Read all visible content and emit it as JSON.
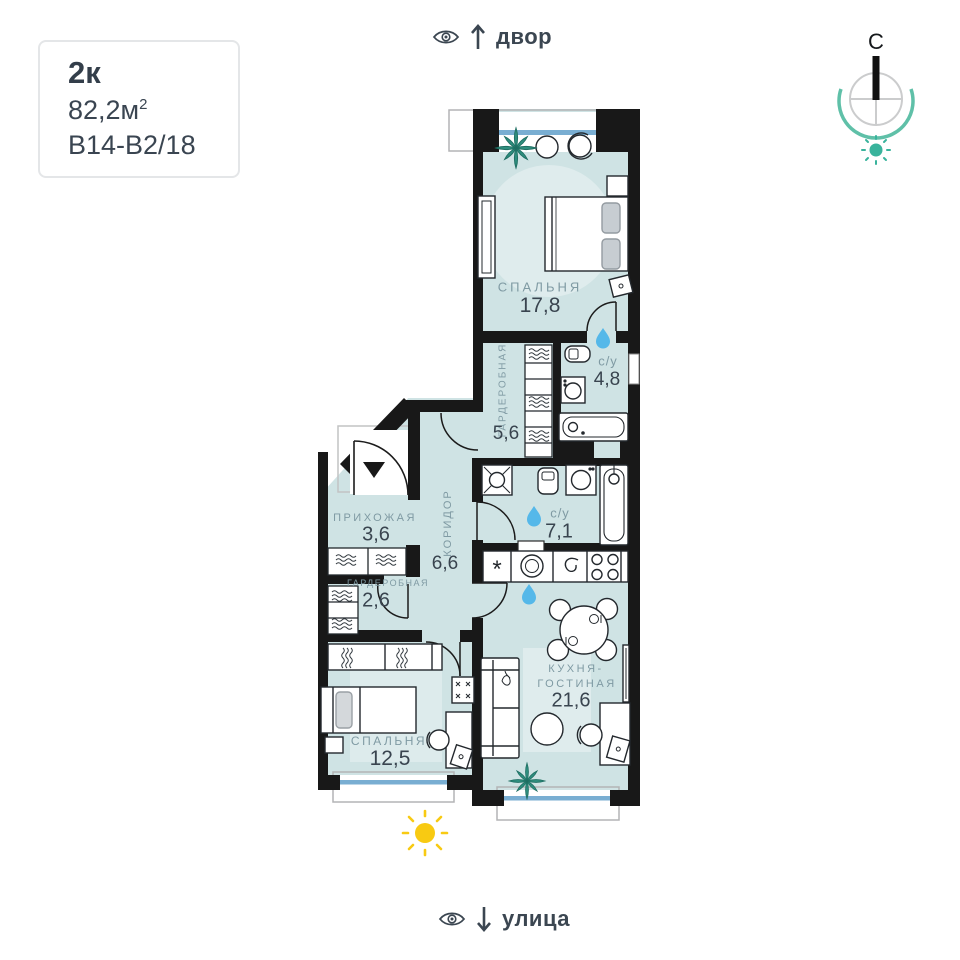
{
  "card": {
    "type_label": "2к",
    "area_value": "82,2м",
    "area_sup": "2",
    "plan_code": "В14-В2/18"
  },
  "orientation": {
    "top_view_label": "двор",
    "bottom_view_label": "улица",
    "compass_north": "С"
  },
  "rooms": {
    "bedroom_main": {
      "name": "СПАЛЬНЯ",
      "area": "17,8"
    },
    "wardrobe_main": {
      "name": "ГАРДЕРОБНАЯ",
      "area": "5,6"
    },
    "bathroom_main": {
      "name": "с/у",
      "area": "4,8"
    },
    "hallway": {
      "name": "ПРИХОЖАЯ",
      "area": "3,6"
    },
    "bathroom_guest": {
      "name": "с/у",
      "area": "7,1"
    },
    "wardrobe_hall": {
      "name": "ГАРДЕРОБНАЯ",
      "area": "2,6"
    },
    "corridor": {
      "name": "КОРИДОР",
      "area": "6,6"
    },
    "kitchen_living": {
      "name_line1": "КУХНЯ-",
      "name_line2": "ГОСТИНАЯ",
      "area": "21,6"
    },
    "bedroom_second": {
      "name": "СПАЛЬНЯ",
      "area": "12,5"
    }
  },
  "symbols": {
    "fridge_symbol": "*"
  },
  "colors": {
    "room_fill": "#cfe3e4",
    "wall": "#181818",
    "window_glass_blue": "#79aed2",
    "water_drop_blue": "#55b8e9",
    "plant_teal": "#2f8f7f",
    "compass_teal": "#5fc0a8",
    "sun_yellow": "#f8ca12",
    "room_label_gray": "#7f9aa3",
    "number_dark": "#39444f"
  }
}
